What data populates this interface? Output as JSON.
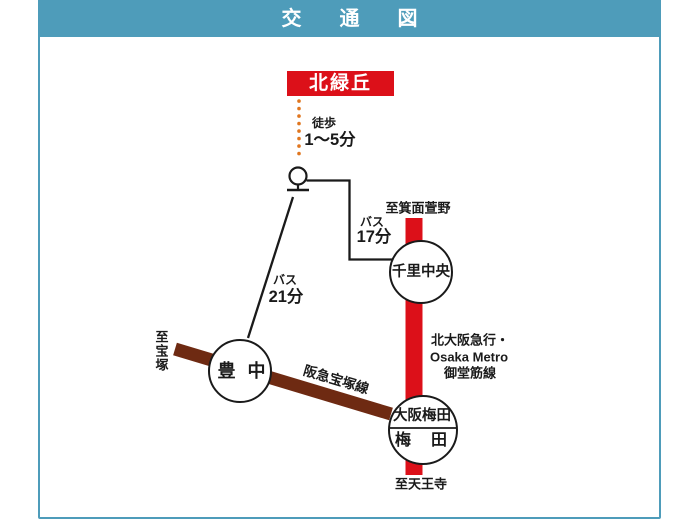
{
  "header": {
    "title": "交　通　図"
  },
  "origin": {
    "label": "北緑丘"
  },
  "access": {
    "walk": {
      "mode": "徒歩",
      "time": "1〜5分"
    },
    "bus_to_senri": {
      "mode": "バス",
      "time": "17分"
    },
    "bus_to_toyonaka": {
      "mode": "バス",
      "time": "21分"
    }
  },
  "stations": {
    "senri_chuo": "千里中央",
    "toyonaka": "豊　中",
    "osaka_umeda": "大阪梅田",
    "umeda": "梅　田"
  },
  "directions": {
    "to_minoh_kayano": "至箕面萱野",
    "to_tennoji": "至天王寺",
    "to_takarazuka": "至宝塚"
  },
  "rail_lines": {
    "midosuji_label_1": "北大阪急行・",
    "midosuji_label_2": "Osaka Metro",
    "midosuji_label_3": "御堂筋線",
    "hankyu_takarazuka": "阪急宝塚線"
  },
  "colors": {
    "teal": "#4E9CBA",
    "red": "#DC1019",
    "brown": "#6E2A12",
    "orange": "#E0761F",
    "ink": "#1a1a1a"
  }
}
